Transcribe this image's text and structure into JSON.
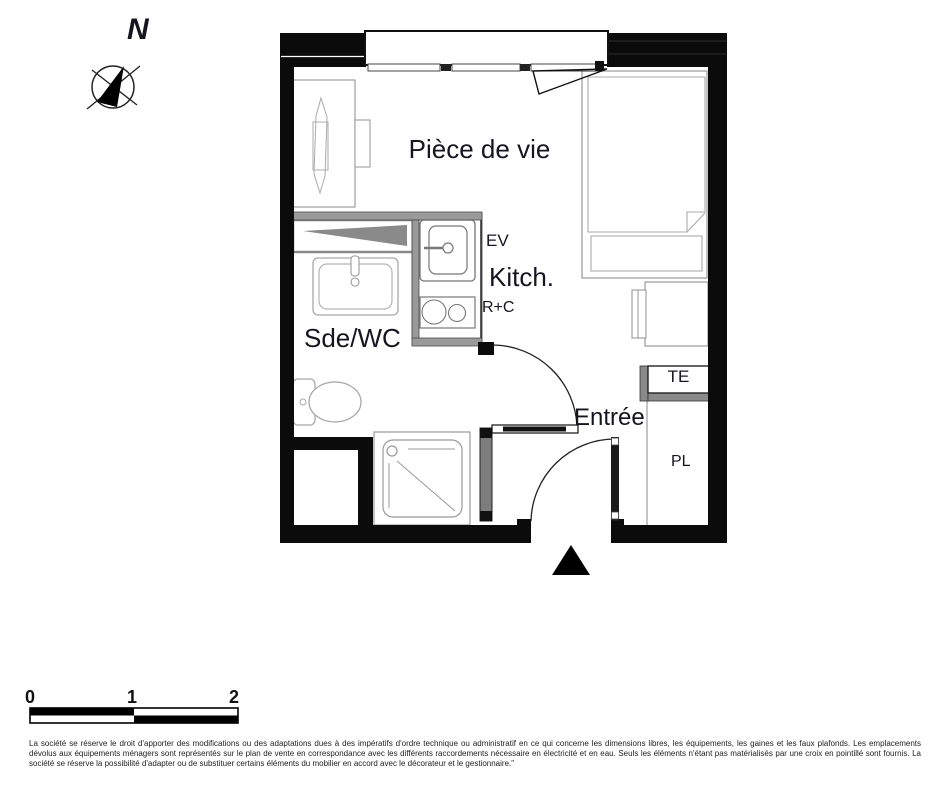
{
  "compass": {
    "north": "N"
  },
  "rooms": {
    "living": "Pièce de vie",
    "kitchen": "Kitch.",
    "bathroom": "Sde/WC",
    "entrance": "Entrée"
  },
  "equipment": {
    "sink": "EV",
    "fridge_cooktop": "R+C",
    "electrical_panel": "TE",
    "closet": "PL"
  },
  "scale": {
    "ticks": [
      "0",
      "1",
      "2"
    ]
  },
  "disclaimer": "La société se réserve le droit d'apporter des modifications ou des adaptations dues à des impératifs d'ordre technique ou administratif en ce qui concerne les dimensions libres, les équipements, les gaines et les faux plafonds. Les emplacements dévolus aux équipements ménagers sont représentés sur le plan de vente en correspondance avec les différents raccordements nécessaire en électricité et en eau. Seuls les éléments n'étant pas matérialisés par une croix en pointillé sont fournis. La société se réserve la possibilité d'adapter ou de substituer certains éléments du mobilier en accord avec le décorateur et le gestionnaire.\"",
  "colors": {
    "wall": "#0b0b0b",
    "partition_gray": "#9a9a9a",
    "mirror_gray": "#8a8a8a",
    "furniture_outline": "#a0a0a0",
    "text": "#15151f"
  }
}
